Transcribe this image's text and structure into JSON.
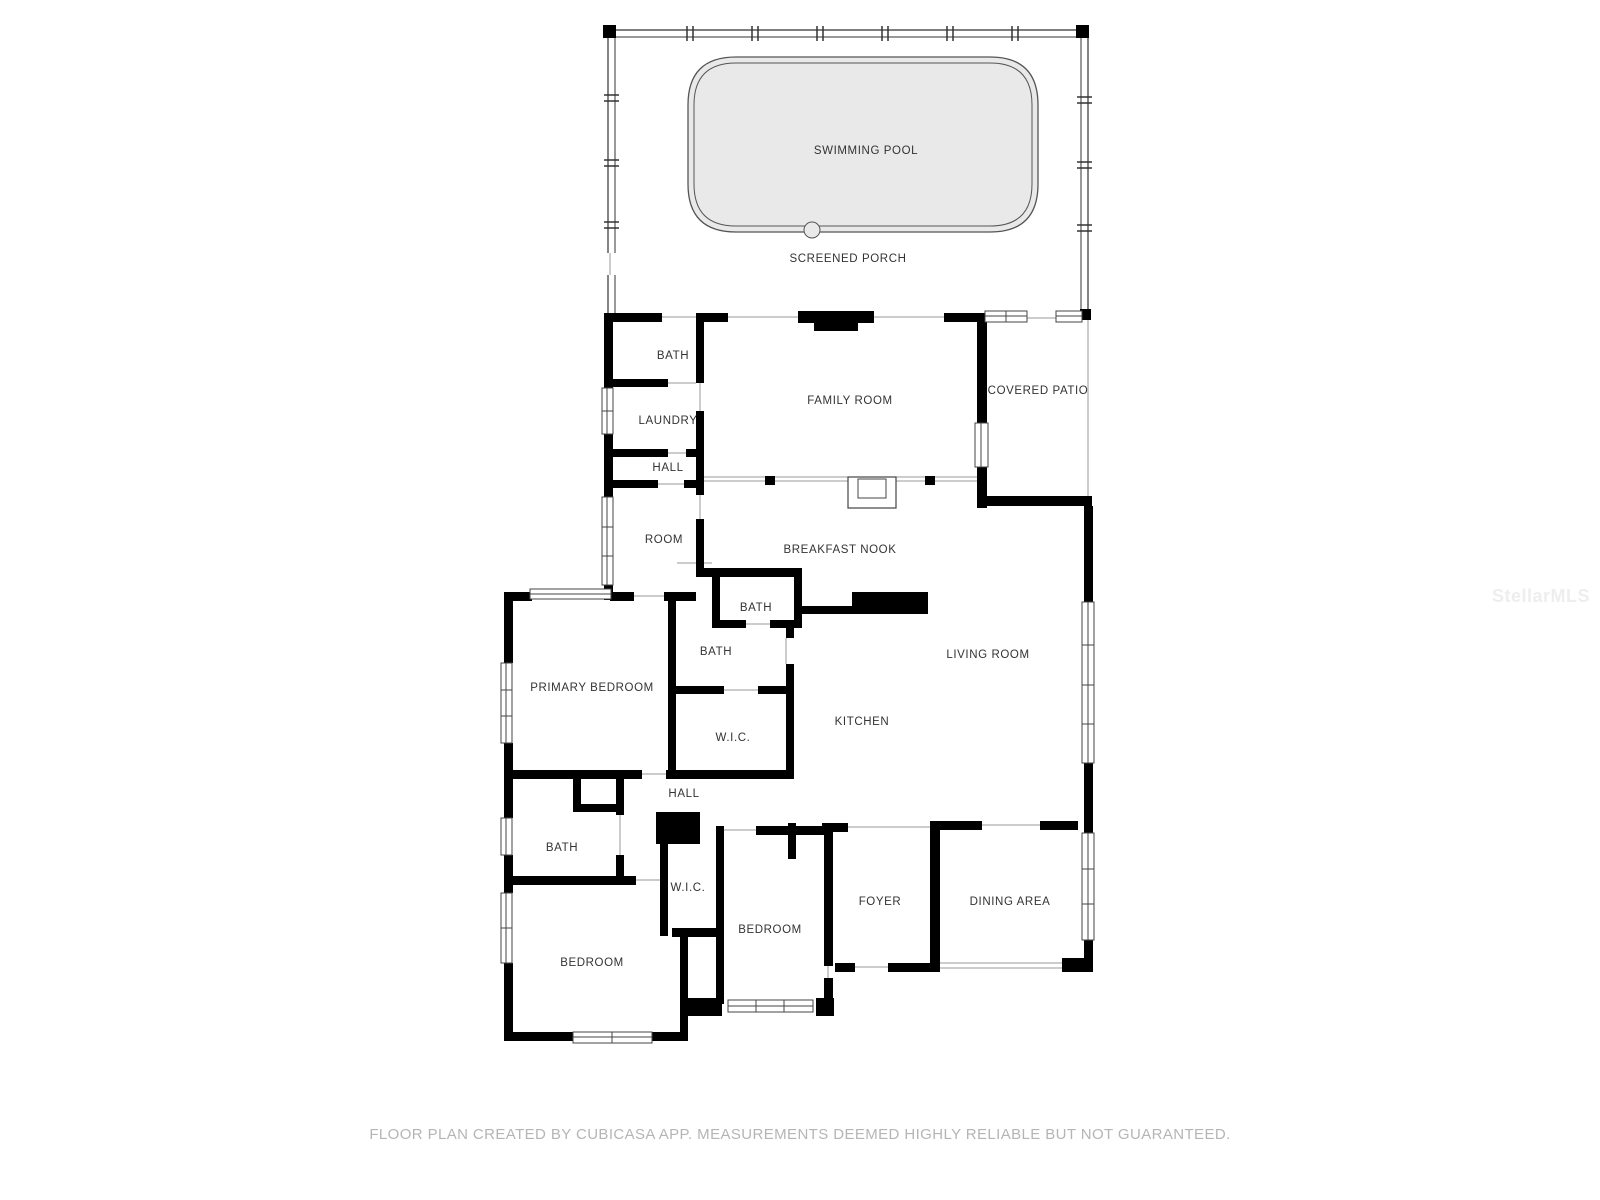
{
  "floorplan": {
    "rooms": [
      {
        "label": "SWIMMING POOL",
        "x": 866,
        "y": 151
      },
      {
        "label": "SCREENED PORCH",
        "x": 848,
        "y": 259
      },
      {
        "label": "BATH",
        "x": 673,
        "y": 356
      },
      {
        "label": "LAUNDRY",
        "x": 668,
        "y": 421
      },
      {
        "label": "FAMILY ROOM",
        "x": 850,
        "y": 401
      },
      {
        "label": "COVERED PATIO",
        "x": 1038,
        "y": 391
      },
      {
        "label": "HALL",
        "x": 668,
        "y": 468
      },
      {
        "label": "ROOM",
        "x": 664,
        "y": 540
      },
      {
        "label": "BREAKFAST NOOK",
        "x": 840,
        "y": 550
      },
      {
        "label": "BATH",
        "x": 756,
        "y": 608
      },
      {
        "label": "BATH",
        "x": 716,
        "y": 652
      },
      {
        "label": "PRIMARY BEDROOM",
        "x": 592,
        "y": 688
      },
      {
        "label": "LIVING ROOM",
        "x": 988,
        "y": 655
      },
      {
        "label": "W.I.C.",
        "x": 733,
        "y": 738
      },
      {
        "label": "KITCHEN",
        "x": 862,
        "y": 722
      },
      {
        "label": "HALL",
        "x": 684,
        "y": 794
      },
      {
        "label": "BATH",
        "x": 562,
        "y": 848
      },
      {
        "label": "W.I.C.",
        "x": 688,
        "y": 888
      },
      {
        "label": "BEDROOM",
        "x": 770,
        "y": 930
      },
      {
        "label": "FOYER",
        "x": 880,
        "y": 902
      },
      {
        "label": "DINING AREA",
        "x": 1010,
        "y": 902
      },
      {
        "label": "BEDROOM",
        "x": 592,
        "y": 963
      }
    ],
    "footer_disclaimer": "FLOOR PLAN CREATED BY CUBICASA APP. MEASUREMENTS DEEMED HIGHLY RELIABLE BUT NOT GUARANTEED.",
    "watermark": "StellarMLS",
    "colors": {
      "wall": "#000000",
      "thin_line": "#9a9a9a",
      "pool_fill": "#e9e9e9",
      "label_text": "#333333",
      "footer_text": "#b5b5b5",
      "watermark_text": "#eeeeee"
    }
  }
}
